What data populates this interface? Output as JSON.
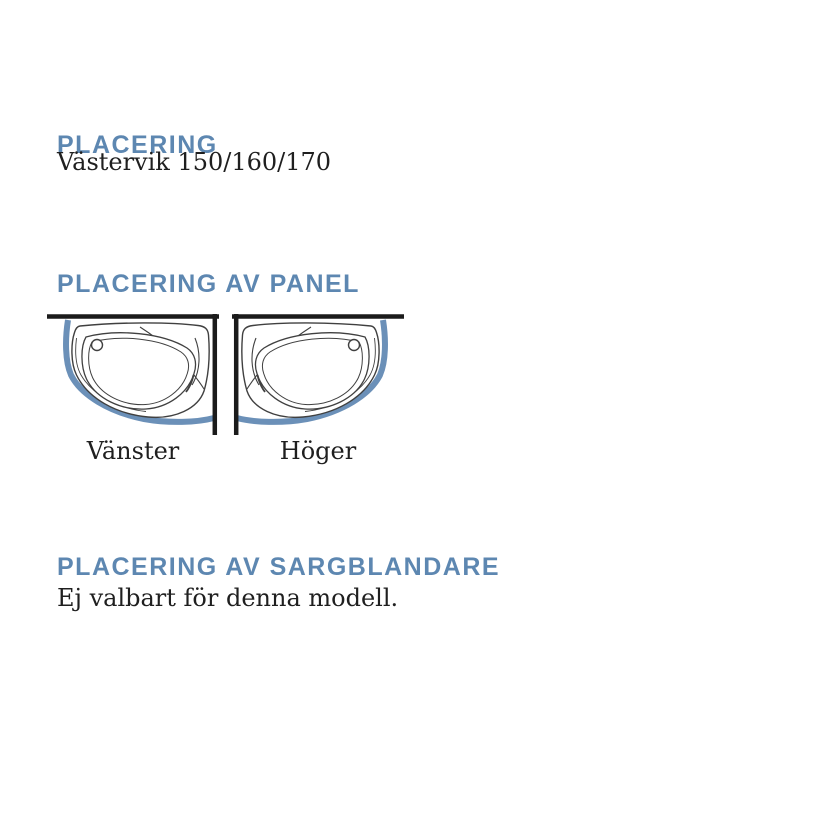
{
  "page": {
    "background": "#ffffff",
    "accent_color": "#5d87b1",
    "text_color": "#1f1f1f"
  },
  "section_placering": {
    "heading": "PLACERING",
    "model": "Västervik 150/160/170"
  },
  "section_panel": {
    "heading": "PLACERING AV PANEL",
    "options": [
      {
        "label": "Vänster"
      },
      {
        "label": "Höger"
      }
    ]
  },
  "section_sargblandare": {
    "heading": "PLACERING AV SARGBLANDARE",
    "note": "Ej valbart för denna modell."
  },
  "diagram": {
    "panel_color": "#6b90b8",
    "wall_color": "#1b1b1b",
    "outline_color": "#404040"
  }
}
